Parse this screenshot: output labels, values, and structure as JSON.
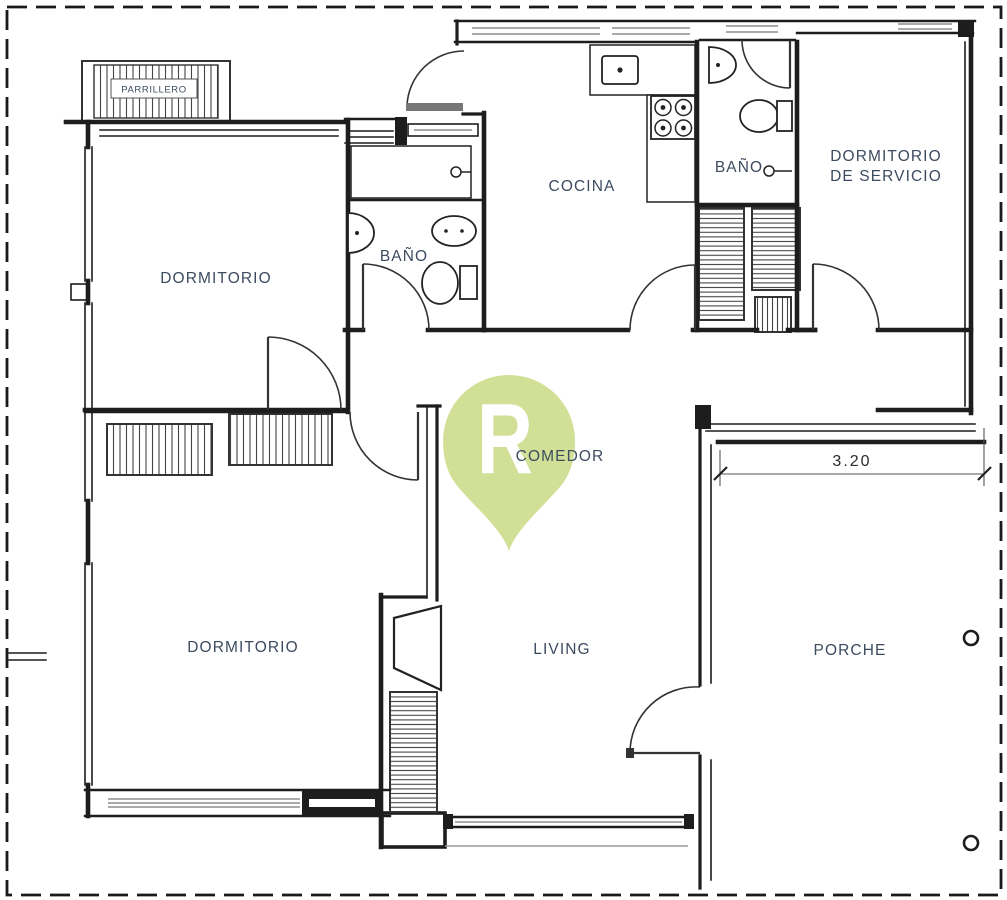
{
  "colors": {
    "wall": "#1d1d1d",
    "label": "#3c4b5f",
    "pin": "#cdde8e",
    "pin_letter": "#ffffff",
    "background": "#ffffff"
  },
  "rooms": {
    "parrillero": {
      "label": "PARRILLERO"
    },
    "dormitorio_principal": {
      "label": "DORMITORIO"
    },
    "bano_principal": {
      "label": "BAÑO"
    },
    "cocina": {
      "label": "COCINA"
    },
    "bano_servicio": {
      "label": "BAÑO"
    },
    "dormitorio_servicio": {
      "label_line_1": "DORMITORIO",
      "label_line_2": "DE SERVICIO"
    },
    "comedor": {
      "label": "COMEDOR"
    },
    "dormitorio_segundo": {
      "label": "DORMITORIO"
    },
    "living": {
      "label": "LIVING"
    },
    "porche": {
      "label": "PORCHE"
    }
  },
  "dimensions": {
    "porch_width": {
      "value": "3.20"
    }
  },
  "watermark": {
    "letter": "R"
  }
}
